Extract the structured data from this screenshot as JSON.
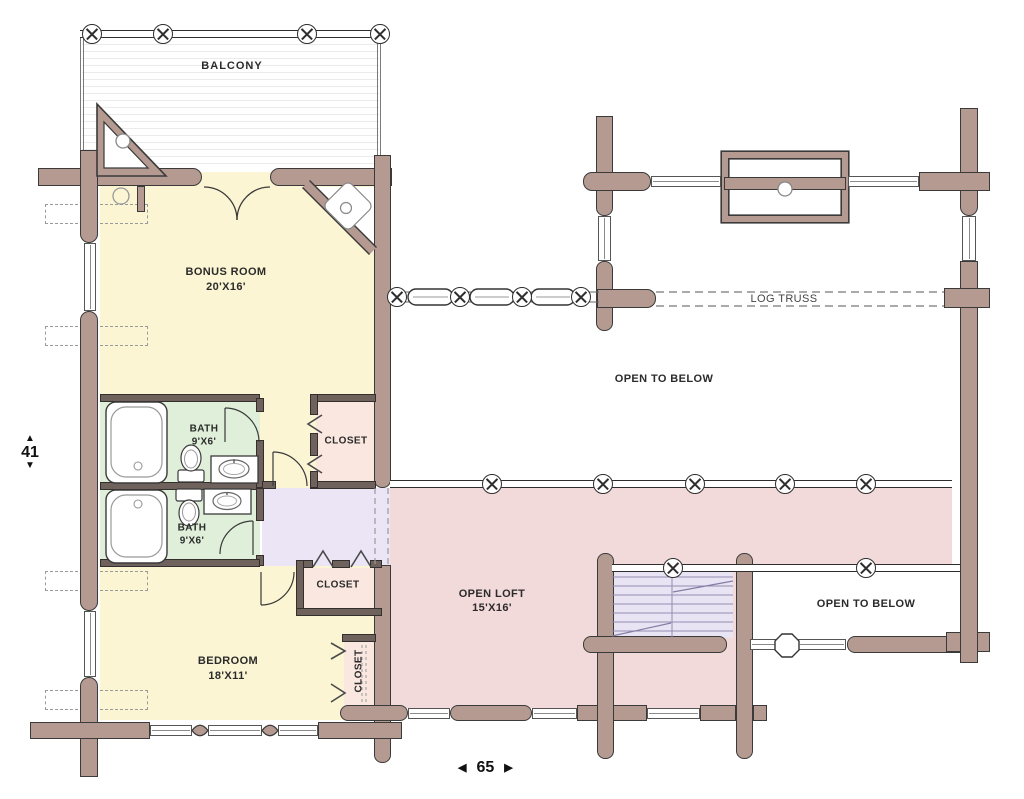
{
  "plan": {
    "rooms": {
      "balcony": {
        "label": "BALCONY"
      },
      "bonus_room": {
        "label": "BONUS ROOM",
        "size": "20'X16'"
      },
      "bath_upper": {
        "label": "BATH",
        "size": "9'X6'"
      },
      "bath_lower": {
        "label": "BATH",
        "size": "9'X6'"
      },
      "closet_upper": {
        "label": "CLOSET"
      },
      "closet_lower": {
        "label": "CLOSET"
      },
      "closet_side": {
        "label": "CLOSET"
      },
      "bedroom": {
        "label": "BEDROOM",
        "size": "18'X11'"
      },
      "open_loft": {
        "label": "OPEN LOFT",
        "size": "15'X16'"
      },
      "open_to_below_upper": {
        "label": "OPEN TO BELOW"
      },
      "open_to_below_lower": {
        "label": "OPEN TO BELOW"
      },
      "log_truss": {
        "label": "LOG TRUSS"
      }
    },
    "dimensions": {
      "height": {
        "value": "41",
        "arrow_up": "▲",
        "arrow_down": "▼"
      },
      "width": {
        "value": "65",
        "arrow_left": "◀",
        "arrow_right": "▶"
      }
    },
    "colors": {
      "log_wall": "#b49a90",
      "outline": "#3a3a3a",
      "room_yellow": "#fbf5d4",
      "bath_green": "#e0efda",
      "closet_pink": "#f9e7e0",
      "hall_lavender": "#ebe5f6",
      "loft_rose": "#f2d9da",
      "stairs_lavender": "#e9e4f4"
    }
  }
}
